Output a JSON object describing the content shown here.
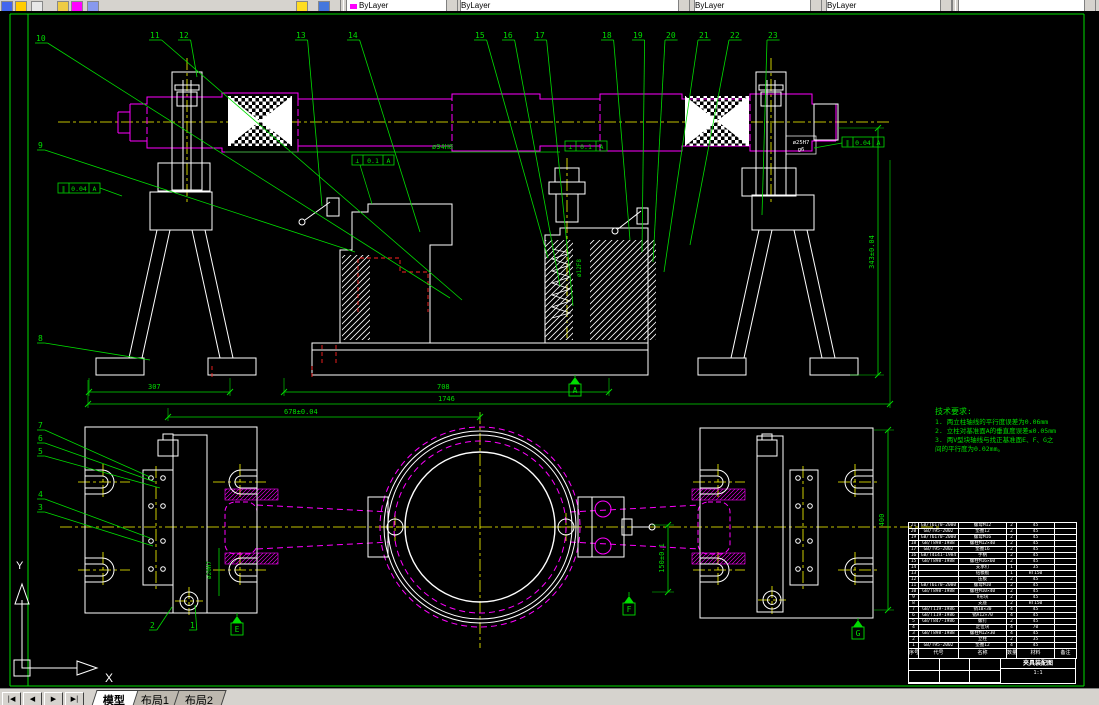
{
  "toolbar": {
    "combos": [
      {
        "x": 346,
        "w": 110,
        "label": "ByLayer",
        "swatch": "#ff00ff"
      },
      {
        "x": 460,
        "w": 228,
        "label": "ByLayer",
        "swatch": ""
      },
      {
        "x": 694,
        "w": 126,
        "label": "ByLayer",
        "swatch": ""
      },
      {
        "x": 826,
        "w": 124,
        "label": "ByLayer",
        "swatch": ""
      },
      {
        "x": 958,
        "w": 136,
        "label": "",
        "swatch": ""
      }
    ],
    "icons": [
      {
        "x": 1,
        "c": "#4466ee"
      },
      {
        "x": 15,
        "c": "#ffcc00"
      },
      {
        "x": 31,
        "c": "#e8e8e8"
      },
      {
        "x": 57,
        "c": "#eecc44"
      },
      {
        "x": 71,
        "c": "#ff00ff"
      },
      {
        "x": 87,
        "c": "#8899ee"
      },
      {
        "x": 296,
        "c": "#ffdd22"
      },
      {
        "x": 318,
        "c": "#4477dd"
      }
    ]
  },
  "tabs": {
    "nav": [
      "|◀",
      "◀",
      "▶",
      "▶|"
    ],
    "items": [
      "模型",
      "布局1",
      "布局2"
    ],
    "active": 0
  },
  "ucs": {
    "x_label": "X",
    "y_label": "Y"
  },
  "colors": {
    "line": "#00dd00",
    "part": "#ff00ff",
    "center": "#ffff00",
    "geom": "#ffffff",
    "aux": "#ff2222"
  },
  "tech_req": {
    "title": "技术要求:",
    "lines": [
      "1. 两立柱轴线的平行度误差为0.06mm",
      "2. 立柱对基准面A的垂直度误差≤0.05mm",
      "3. 两V型块轴线与找正基准面E、F、G之",
      "间的平行度为0.02mm。"
    ]
  },
  "drawing": {
    "balloons": [
      {
        "n": "1",
        "bx": 190,
        "by": 628,
        "tx": 195,
        "ty": 605
      },
      {
        "n": "2",
        "bx": 150,
        "by": 628,
        "tx": 172,
        "ty": 607
      },
      {
        "n": "3",
        "bx": 38,
        "by": 510,
        "tx": 153,
        "ty": 546
      },
      {
        "n": "4",
        "bx": 38,
        "by": 497,
        "tx": 150,
        "ty": 538
      },
      {
        "n": "5",
        "bx": 38,
        "by": 454,
        "tx": 160,
        "ty": 488
      },
      {
        "n": "6",
        "bx": 38,
        "by": 441,
        "tx": 155,
        "ty": 482
      },
      {
        "n": "7",
        "bx": 38,
        "by": 428,
        "tx": 150,
        "ty": 477
      },
      {
        "n": "8",
        "bx": 38,
        "by": 341,
        "tx": 150,
        "ty": 360
      },
      {
        "n": "9",
        "bx": 38,
        "by": 148,
        "tx": 355,
        "ty": 252
      },
      {
        "n": "10",
        "bx": 36,
        "by": 41,
        "tx": 450,
        "ty": 298
      },
      {
        "n": "11",
        "bx": 150,
        "by": 38,
        "tx": 462,
        "ty": 300
      },
      {
        "n": "12",
        "bx": 179,
        "by": 38,
        "tx": 197,
        "ty": 77
      },
      {
        "n": "13",
        "bx": 296,
        "by": 38,
        "tx": 322,
        "ty": 206
      },
      {
        "n": "14",
        "bx": 348,
        "by": 38,
        "tx": 420,
        "ty": 232
      },
      {
        "n": "15",
        "bx": 475,
        "by": 38,
        "tx": 548,
        "ty": 258
      },
      {
        "n": "16",
        "bx": 503,
        "by": 38,
        "tx": 560,
        "ty": 286
      },
      {
        "n": "17",
        "bx": 535,
        "by": 38,
        "tx": 573,
        "ty": 306
      },
      {
        "n": "18",
        "bx": 602,
        "by": 38,
        "tx": 630,
        "ty": 240
      },
      {
        "n": "19",
        "bx": 633,
        "by": 38,
        "tx": 642,
        "ty": 252
      },
      {
        "n": "20",
        "bx": 666,
        "by": 38,
        "tx": 653,
        "ty": 262
      },
      {
        "n": "21",
        "bx": 699,
        "by": 38,
        "tx": 664,
        "ty": 272
      },
      {
        "n": "22",
        "bx": 730,
        "by": 38,
        "tx": 690,
        "ty": 245
      },
      {
        "n": "23",
        "bx": 768,
        "by": 38,
        "tx": 762,
        "ty": 215
      }
    ],
    "dims": [
      {
        "text": "307",
        "line": [
          89,
          392,
          230,
          392
        ],
        "ext": [
          [
            89,
            378,
            89,
            396
          ],
          [
            230,
            378,
            230,
            396
          ]
        ],
        "t": [
          148,
          389
        ],
        "rot": 0
      },
      {
        "text": "708",
        "line": [
          284,
          392,
          609,
          392
        ],
        "ext": [
          [
            284,
            378,
            284,
            396
          ],
          [
            609,
            378,
            609,
            396
          ]
        ],
        "t": [
          437,
          389
        ],
        "rot": 0
      },
      {
        "text": "1746",
        "line": [
          88,
          404,
          890,
          404
        ],
        "ext": [
          [
            88,
            380,
            88,
            408
          ],
          [
            890,
            160,
            890,
            408
          ]
        ],
        "t": [
          438,
          401
        ],
        "rot": 0
      },
      {
        "text": "678±0.04",
        "line": [
          168,
          417,
          480,
          417
        ],
        "ext": [
          [
            168,
            408,
            168,
            421
          ],
          [
            480,
            412,
            480,
            421
          ]
        ],
        "t": [
          284,
          414
        ],
        "rot": 0
      },
      {
        "text": "343±0.04",
        "line": [
          878,
          128,
          878,
          375
        ],
        "ext": [
          [
            838,
            128,
            884,
            128
          ],
          [
            850,
            375,
            884,
            375
          ]
        ],
        "t": [
          874,
          252
        ],
        "rot": -90
      },
      {
        "text": "400",
        "line": [
          888,
          430,
          888,
          610
        ],
        "ext": [
          [
            874,
            430,
            894,
            430
          ],
          [
            874,
            610,
            894,
            610
          ]
        ],
        "t": [
          884,
          520
        ],
        "rot": -90
      },
      {
        "text": "150±0.1",
        "line": [
          668,
          525,
          668,
          592
        ],
        "ext": [
          [
            652,
            525,
            674,
            525
          ],
          [
            652,
            592,
            674,
            592
          ]
        ],
        "t": [
          664,
          558
        ],
        "rot": -90
      }
    ],
    "frames": [
      {
        "x": 565,
        "y": 141,
        "cells": [
          "⊥",
          "0.1",
          "A"
        ],
        "leader": []
      },
      {
        "x": 352,
        "y": 155,
        "cells": [
          "⊥",
          "0.1",
          "A"
        ],
        "leader": [
          360,
          165,
          372,
          204
        ]
      },
      {
        "x": 842,
        "y": 137,
        "cells": [
          "∥",
          "0.04",
          "A"
        ],
        "leader": [
          842,
          143,
          814,
          148
        ]
      },
      {
        "x": 58,
        "y": 183,
        "cells": [
          "∥",
          "0.04",
          "A"
        ],
        "leader": [
          100,
          188,
          122,
          196
        ]
      }
    ],
    "datums": [
      {
        "label": "A",
        "tri": [
          575,
          377
        ],
        "stem": [
          575,
          375
        ]
      },
      {
        "label": "E",
        "tri": [
          237,
          616
        ],
        "stem": [
          237,
          613
        ]
      },
      {
        "label": "F",
        "tri": [
          629,
          596
        ],
        "stem": [
          629,
          592
        ]
      },
      {
        "label": "G",
        "tri": [
          858,
          620
        ],
        "stem": [
          858,
          618
        ]
      }
    ],
    "labels": [
      {
        "text": "ø94H8",
        "x": 432,
        "y": 149,
        "c": "#00dd00",
        "size": 7,
        "rot": 0,
        "anchor": "start"
      },
      {
        "text": "ø12F8",
        "x": 581,
        "y": 268,
        "c": "#00dd00",
        "size": 6,
        "rot": -90,
        "anchor": "middle"
      },
      {
        "text": "ø20H7",
        "x": 211,
        "y": 570,
        "c": "#00dd00",
        "size": 6,
        "rot": -90,
        "anchor": "middle"
      },
      {
        "text": "ø25H7",
        "x": 801,
        "y": 144,
        "c": "#ffffff",
        "size": 5.5,
        "rot": 0,
        "anchor": "middle"
      },
      {
        "text": "g6",
        "x": 801,
        "y": 151,
        "c": "#ffffff",
        "size": 5.5,
        "rot": 0,
        "anchor": "middle"
      }
    ]
  },
  "parts_table": {
    "headers": [
      "序号",
      "代号",
      "名称",
      "数量",
      "材料",
      "备注"
    ],
    "rows": [
      [
        "21",
        "GB/T6170-2000",
        "螺母M12",
        "2",
        "45",
        ""
      ],
      [
        "20",
        "GB/T95-2002",
        "垫圈12",
        "2",
        "45",
        ""
      ],
      [
        "19",
        "GB/T6170-2000",
        "螺母M16",
        "2",
        "45",
        ""
      ],
      [
        "18",
        "GB/T898-1988",
        "螺柱M12×40",
        "2",
        "45",
        ""
      ],
      [
        "17",
        "GB/T95-2002",
        "垫圈16",
        "2",
        "45",
        ""
      ],
      [
        "16",
        "GB/T4141-1984",
        "手柄",
        "2",
        "45",
        ""
      ],
      [
        "15",
        "GB/T898-1988",
        "螺柱M16×60",
        "2",
        "45",
        ""
      ],
      [
        "14",
        "",
        "支承钉",
        "1",
        "35",
        ""
      ],
      [
        "13",
        "",
        "钻模板",
        "1",
        "HT150",
        ""
      ],
      [
        "12",
        "",
        "压板",
        "2",
        "45",
        ""
      ],
      [
        "11",
        "GB/T6170-2000",
        "螺母M10",
        "2",
        "45",
        ""
      ],
      [
        "10",
        "GB/T898-1988",
        "螺柱M10×40",
        "2",
        "45",
        ""
      ],
      [
        "9",
        "",
        "V形块",
        "2",
        "45",
        ""
      ],
      [
        "8",
        "",
        "支座",
        "2",
        "HT150",
        ""
      ],
      [
        "7",
        "GB/T119-1986",
        "销10×30",
        "4",
        "45",
        ""
      ],
      [
        "6",
        "GB/T119-1986",
        "销A12×70",
        "4",
        "45",
        ""
      ],
      [
        "5",
        "GB/T847-1986",
        "螺钉",
        "2",
        "45",
        ""
      ],
      [
        "4",
        "",
        "定位块",
        "4",
        "70",
        ""
      ],
      [
        "3",
        "GB/T898-1988",
        "螺柱M12×30",
        "4",
        "45",
        ""
      ],
      [
        "2",
        "",
        "立柱",
        "2",
        "35",
        ""
      ],
      [
        "1",
        "GB/T95-2002",
        "垫圈12",
        "4",
        "45",
        ""
      ]
    ],
    "title_block": {
      "title": "夹具装配图",
      "scale": "1:1"
    }
  }
}
